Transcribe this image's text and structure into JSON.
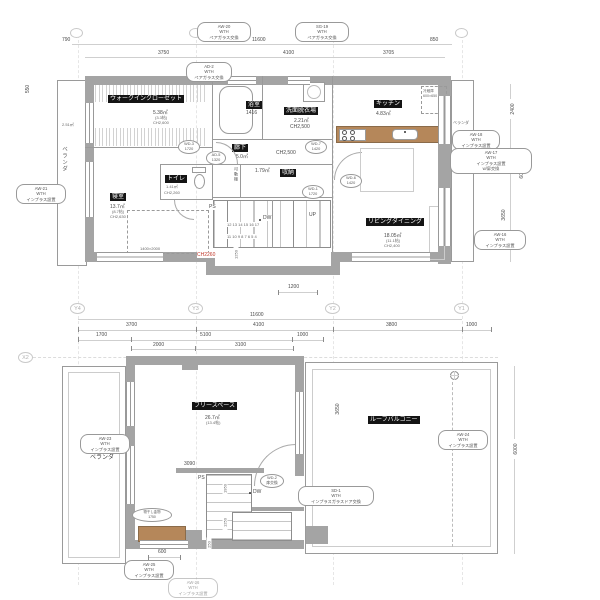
{
  "upper": {
    "rooms": {
      "closet": {
        "name": "ウォークインクローゼット",
        "area": "5.38㎡",
        "tatami": "(3.3帖)",
        "ch": "CH2,600"
      },
      "bedroom": {
        "name": "寝室",
        "area": "13.7㎡",
        "tatami": "(8.7帖)",
        "ch": "CH2,630",
        "bed": "1400×2000"
      },
      "bath": {
        "name": "浴室",
        "size": "1416"
      },
      "washroom": {
        "name": "洗面脱衣場",
        "area": "2.21㎡",
        "ch": "CH2,500"
      },
      "hall": {
        "name": "廊下",
        "area": "5.0㎡",
        "ch": "CH2,500"
      },
      "wc": {
        "name": "トイレ",
        "area": "1.41㎡",
        "ch": "CH2,260"
      },
      "storage": {
        "name": "収納",
        "area": "1.79㎡",
        "shelf": "可動棚"
      },
      "kitchen": {
        "name": "キッチン",
        "area": "4.83㎡",
        "fridge": "冷蔵庫\n600×650"
      },
      "living": {
        "name": "リビングダイニング",
        "area": "18.05㎡",
        "tatami": "(11.1帖)",
        "ch": "CH2,400"
      }
    },
    "veranda_left": {
      "label": "ベランダ",
      "area": "2.51㎡"
    },
    "veranda_right": {
      "label": "ベランダ"
    },
    "stair": {
      "ps": "PS",
      "dw": "DW",
      "up": "UP",
      "row_top": "12 13 14 15 16 17",
      "row_bottom": "11 10 9 8 7 6 5 4",
      "ch_red": "CH2260"
    },
    "dims": {
      "d790": "790",
      "d11600": "11600",
      "d850": "850",
      "d3750": "3750",
      "d4100": "4100",
      "d3705": "3705",
      "d550": "550",
      "d2400": "2400",
      "d6000": "6000",
      "d3650": "3650",
      "d1250": "1250",
      "d1200": "1200"
    },
    "tags": {
      "aw20": "AW-20\nW7H\nペアガラス交換",
      "sg19": "SG-19\nW7H\nペアガラス交換",
      "ad2": "AD-2\nW7H\nペアガラス交換",
      "aw21": "AW-21\nW7H\nインプラス設置",
      "aw18": "AW-18\nW7H\nインプラス設置",
      "aw17": "AW-17\nW7H\nインプラス設置\nw/扉交換",
      "aw16": "AW-16\nW7H\nインプラス設置"
    },
    "ovals": {
      "wd3": "WD-3\n1720",
      "ad5": "AD-5\n1320",
      "wd7": "WD-7\n1420",
      "wd1": "WD-1\n1720",
      "wd6": "WD-6\n1420"
    }
  },
  "grid": {
    "y4": "Y4",
    "y3": "Y3",
    "y2": "Y2",
    "y1": "Y1",
    "x2": "X2"
  },
  "mid_dims": {
    "total": "11600",
    "a1": "3700",
    "a2": "4100",
    "a3": "3800",
    "a4": "1000",
    "b1": "1700",
    "b2": "5100",
    "b3": "1000",
    "c1": "2000",
    "c2": "3100"
  },
  "lower": {
    "rooms": {
      "free_space": {
        "name": "フリースペース",
        "area": "26.7㎡",
        "tatami": "(13.4帖)"
      },
      "roof_balcony": {
        "name": "ルーフバルコニー"
      },
      "veranda": {
        "label": "ベランダ"
      }
    },
    "stair": {
      "ps": "PS",
      "dw": "DW"
    },
    "dims": {
      "d3090": "3090",
      "d1950": "1950",
      "d1250": "1250",
      "d250": "250",
      "d600": "600",
      "d2350": "2350",
      "d3650": "3650",
      "d6000": "6000"
    },
    "tags": {
      "aw23": "AW-23\nW7H\nインプラス設置",
      "aw24": "AW-24\nW7H\nインプラス設置",
      "aw25": "AW-25\nW7H\nインプラス設置",
      "aw26": "AW-26\nW7H\nインプラス設置",
      "sd1": "SD-1\nW7H\nインプラスガラスドア交換"
    },
    "ovals": {
      "wd2": "WD-2\n扉交換",
      "hang": "物干し金物\n1750"
    }
  }
}
